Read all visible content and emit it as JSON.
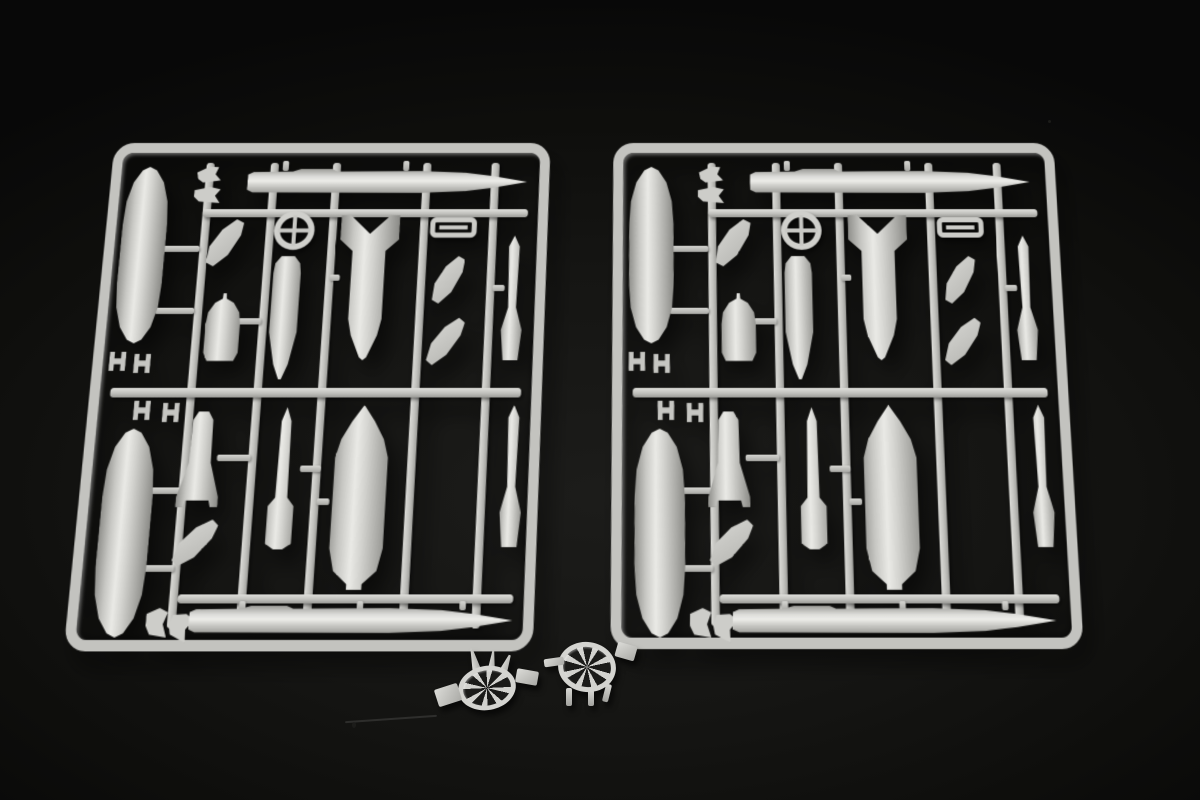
{
  "scene": {
    "description": "Product photograph of two identical light-grey injection-moulded model-kit sprues holding aircraft ordnance parts (drop tanks, bombs, cruise missiles, fins, sway braces) on a black cloth background; two small loose fuze-propeller wheel parts sit below the sprues. No text is visible in the image.",
    "colors": {
      "background": "#121210",
      "plastic_mid": "#c9c9c5",
      "plastic_highlight": "#ecece8",
      "plastic_shadow": "#8e8e8a",
      "frame": "#c3c3bf"
    }
  },
  "sprues": {
    "left": {
      "label": "Ordnance sprue, left copy"
    },
    "right": {
      "label": "Ordnance sprue, right copy (identical)"
    }
  },
  "parts": {
    "top_missile": "Cruise missile body, nose right (top row)",
    "top_small_parts": "Small angled fittings beside missile tail",
    "drop_tank_upper": "Large drop tank (upper left column)",
    "drop_tank_lower": "Large drop tank (lower left column)",
    "sway_braces_a": "Sway-brace clip pair (above centre runner)",
    "sway_braces_b": "Sway-brace clip pair (below centre runner)",
    "curved_fin_a": "Curved fin fragment",
    "curved_fin_b": "Curved fin fragment",
    "curved_fin_c": "Curved fin fragment",
    "curved_fin_d": "Curved fin fragment",
    "bomblet": "Small rounded pod / bomblet",
    "ring_part": "Ring collar with cross web",
    "slender_store": "Slender store body, pointed tail",
    "finned_bomb": "Bomb with box tail fins, nose down (top centre)",
    "rect_link": "Open pylon adapter frame",
    "slender_missile_a": "Slender missile half (upper right column)",
    "slender_missile_b": "Slender missile half (lower right column)",
    "tail_bomb": "Bomb with splayed tail fins",
    "slim_bomb": "Slim bomb with box fin, pointed nose up",
    "heavy_bomb": "Heavy bomb / tank, cone nose up (lower centre)",
    "pylon_bits": "Small pylon fittings (bottom row)",
    "bottom_missile": "Cruise missile body with intake hump, nose right (bottom row)"
  },
  "loose_parts": {
    "fuze_wheel_a": "Loose fuze-propeller wheel, tilted with blades up (left)",
    "fuze_wheel_b": "Loose fuze-propeller wheel on legs (right)"
  }
}
